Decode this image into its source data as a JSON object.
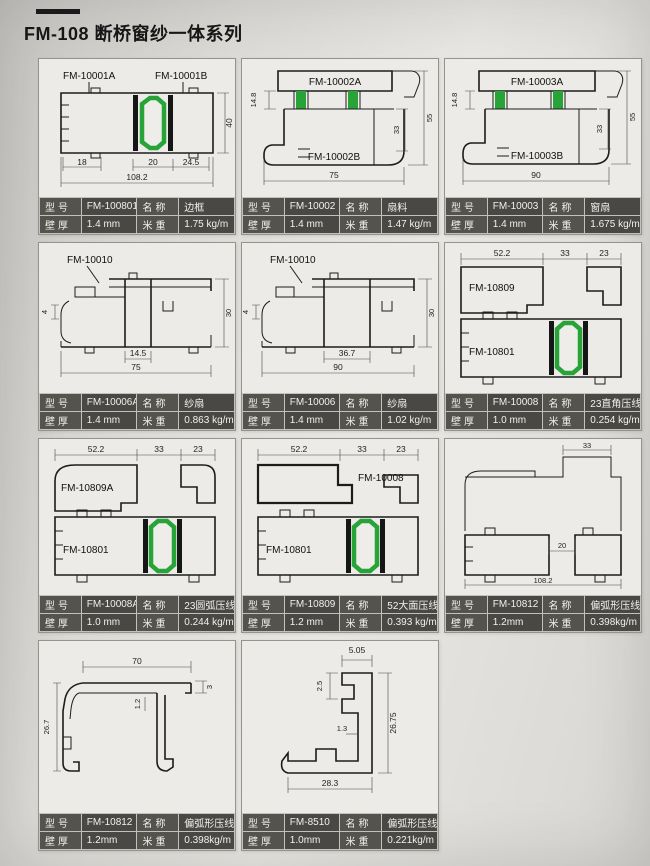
{
  "page": {
    "title": "FM-108 断桥窗纱一体系列",
    "table_headers": {
      "model": "型号",
      "name": "名称",
      "thickness": "壁厚",
      "weight": "米重"
    },
    "colors": {
      "thermal_break_green": "#27a338",
      "table_bg": "#494844",
      "table_label_bg": "#54534d",
      "paper": "#ecebe7"
    }
  },
  "cells": [
    {
      "drawing": {
        "labels": [
          "FM-10001A",
          "FM-10001B"
        ],
        "dims": [
          "18",
          "20",
          "24.5",
          "108.2",
          "40"
        ]
      },
      "table": {
        "model": "FM-100801",
        "name": "边框",
        "thickness": "1.4 mm",
        "weight": "1.75 kg/m"
      }
    },
    {
      "drawing": {
        "labels": [
          "FM-10002A",
          "FM-10002B"
        ],
        "dims": [
          "14.8",
          "33",
          "55",
          "75"
        ]
      },
      "table": {
        "model": "FM-10002",
        "name": "扇料",
        "thickness": "1.4 mm",
        "weight": "1.47 kg/m"
      }
    },
    {
      "drawing": {
        "labels": [
          "FM-10003A",
          "FM-10003B"
        ],
        "dims": [
          "14.8",
          "33",
          "55",
          "90"
        ]
      },
      "table": {
        "model": "FM-10003",
        "name": "窗扇",
        "thickness": "1.4 mm",
        "weight": "1.675 kg/m"
      }
    },
    {
      "drawing": {
        "labels": [
          "FM-10010"
        ],
        "dims": [
          "4",
          "30",
          "14.5",
          "75"
        ]
      },
      "table": {
        "model": "FM-10006A",
        "name": "纱扇",
        "thickness": "1.4 mm",
        "weight": "0.863 kg/m"
      }
    },
    {
      "drawing": {
        "labels": [
          "FM-10010"
        ],
        "dims": [
          "4",
          "30",
          "36.7",
          "90"
        ]
      },
      "table": {
        "model": "FM-10006",
        "name": "纱扇",
        "thickness": "1.4 mm",
        "weight": "1.02 kg/m"
      }
    },
    {
      "drawing": {
        "labels": [
          "FM-10809",
          "FM-10801"
        ],
        "dims": [
          "52.2",
          "33",
          "23"
        ]
      },
      "table": {
        "model": "FM-10008",
        "name": "23直角压线",
        "thickness": "1.0 mm",
        "weight": "0.254 kg/m"
      }
    },
    {
      "drawing": {
        "labels": [
          "FM-10809A",
          "FM-10801"
        ],
        "dims": [
          "52.2",
          "33",
          "23"
        ]
      },
      "table": {
        "model": "FM-10008A",
        "name": "23圆弧压线",
        "thickness": "1.0 mm",
        "weight": "0.244 kg/m"
      }
    },
    {
      "drawing": {
        "labels": [
          "FM-10008",
          "FM-10801"
        ],
        "dims": [
          "52.2",
          "33",
          "23"
        ]
      },
      "table": {
        "model": "FM-10809",
        "name": "52大面压线",
        "thickness": "1.2 mm",
        "weight": "0.393 kg/m"
      }
    },
    {
      "drawing": {
        "labels": [],
        "dims": [
          "33",
          "20",
          "108.2"
        ]
      },
      "table": {
        "model": "FM-10812",
        "name": "偏弧形压线",
        "thickness": "1.2mm",
        "weight": "0.398kg/m"
      }
    },
    {
      "drawing": {
        "labels": [],
        "dims": [
          "70",
          "3",
          "1.2",
          "26.7"
        ]
      },
      "table": {
        "model": "FM-10812",
        "name": "偏弧形压线",
        "thickness": "1.2mm",
        "weight": "0.398kg/m"
      }
    },
    {
      "drawing": {
        "labels": [],
        "dims": [
          "5.05",
          "2.5",
          "1.3",
          "26.75",
          "28.3"
        ]
      },
      "table": {
        "model": "FM-8510",
        "name": "偏弧形压线",
        "thickness": "1.0mm",
        "weight": "0.221kg/m"
      }
    }
  ]
}
